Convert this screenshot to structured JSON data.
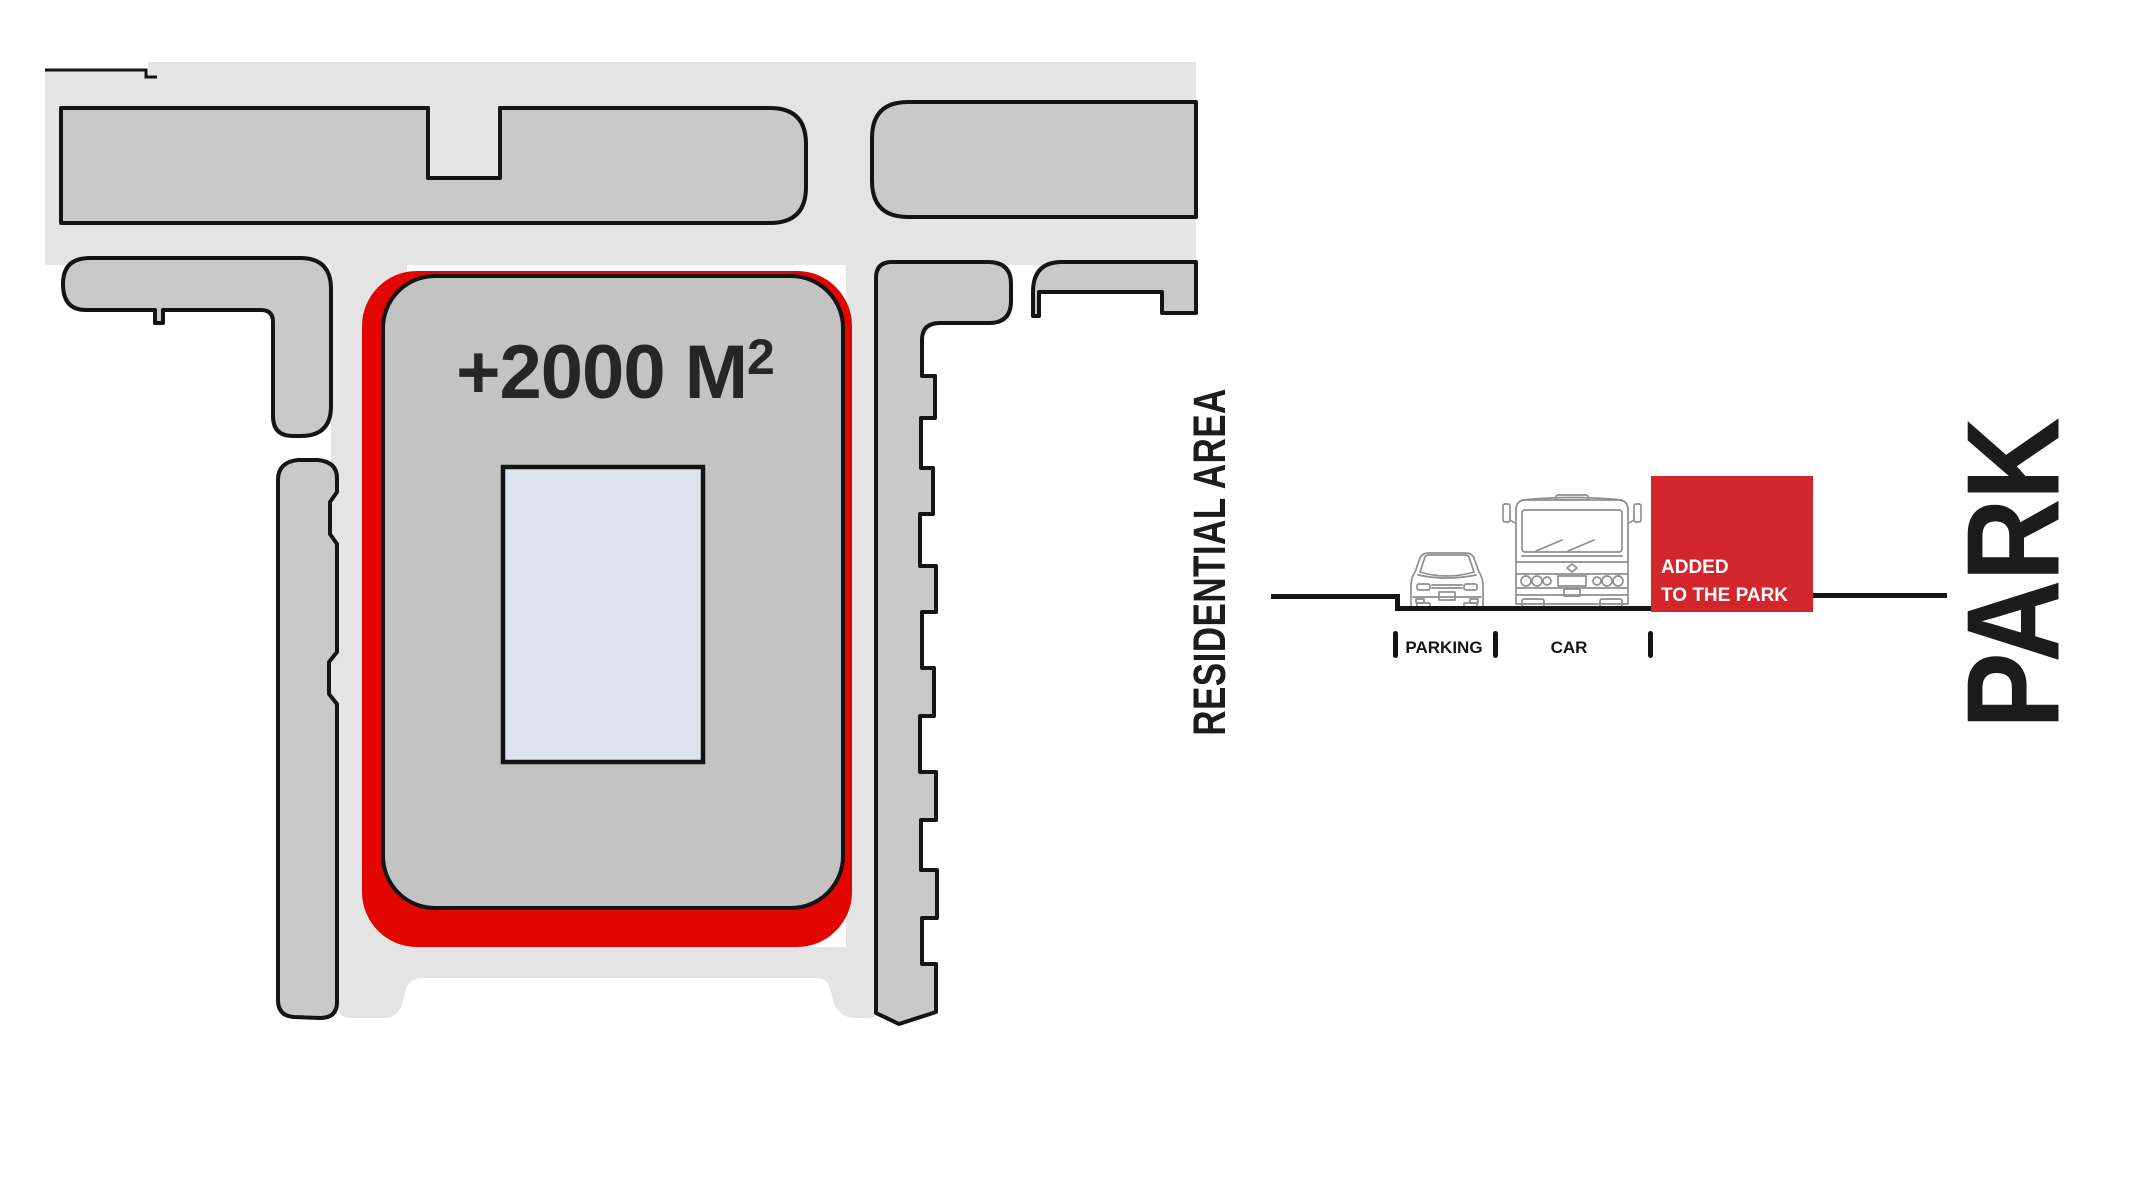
{
  "colors": {
    "road": "#e4e4e4",
    "block": "#c9c9c9",
    "park_fill": "#c3c3c3",
    "inner_fill": "#dde4ee",
    "plan_red": "#e20500",
    "box_red": "#d2262c",
    "ink": "#141414",
    "veh": "#8f8f8f"
  },
  "site_plan": {
    "area_label": "+2000 M",
    "area_sup": "2"
  },
  "section": {
    "residential_label": "RESIDENTIAL AREA",
    "park_label": "PARK",
    "added_box": {
      "line1": "ADDED",
      "line2": "TO THE PARK"
    },
    "zone_labels": {
      "parking": "PARKING",
      "car": "CAR"
    },
    "icons": {
      "car": "car-front-icon",
      "bus": "bus-front-icon"
    }
  }
}
